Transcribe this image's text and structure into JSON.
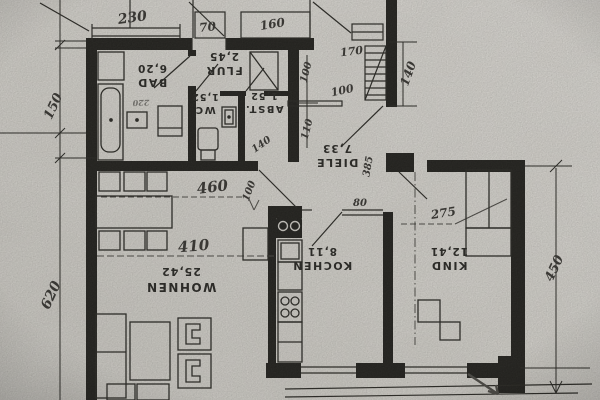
{
  "photo": {
    "description": "scanned German apartment floor plan, plan printed upside-down, hand-annotated dimensions",
    "paper_color": "#d5d2cc",
    "ink_color": "#1d1c1a",
    "pencil_color": "#3b3a38"
  },
  "rooms": {
    "bad": {
      "name": "BAD",
      "area": "6,20"
    },
    "flur": {
      "name": "FLUR",
      "area": "2,45"
    },
    "wc": {
      "name": "WC",
      "area": "1,52"
    },
    "abst": {
      "name": "ABST.",
      "area": "1,52"
    },
    "diele": {
      "name": "DIELE",
      "area": "7,33"
    },
    "wohnen": {
      "name": "WOHNEN",
      "area": "25,42"
    },
    "kochen": {
      "name": "KOCHEN",
      "area": "8,11"
    },
    "kind": {
      "name": "KIND",
      "area": "12,41"
    }
  },
  "dimensions": {
    "win_bad": "230",
    "win_flur": "70",
    "win_diele": "160",
    "entry_width": "170",
    "entry_depth": "140",
    "niche_upper": "100",
    "niche_lower": "110",
    "entry_inner": "100",
    "left_upper": "150",
    "left_lower": "620",
    "right_side": "450",
    "wohnen_upper": "460",
    "wohnen_lower": "410",
    "wohnen_door": "100",
    "kind_width": "275",
    "diele_length": "385",
    "kochen_door": "80",
    "abst_note": "140",
    "bad_note": "220"
  }
}
